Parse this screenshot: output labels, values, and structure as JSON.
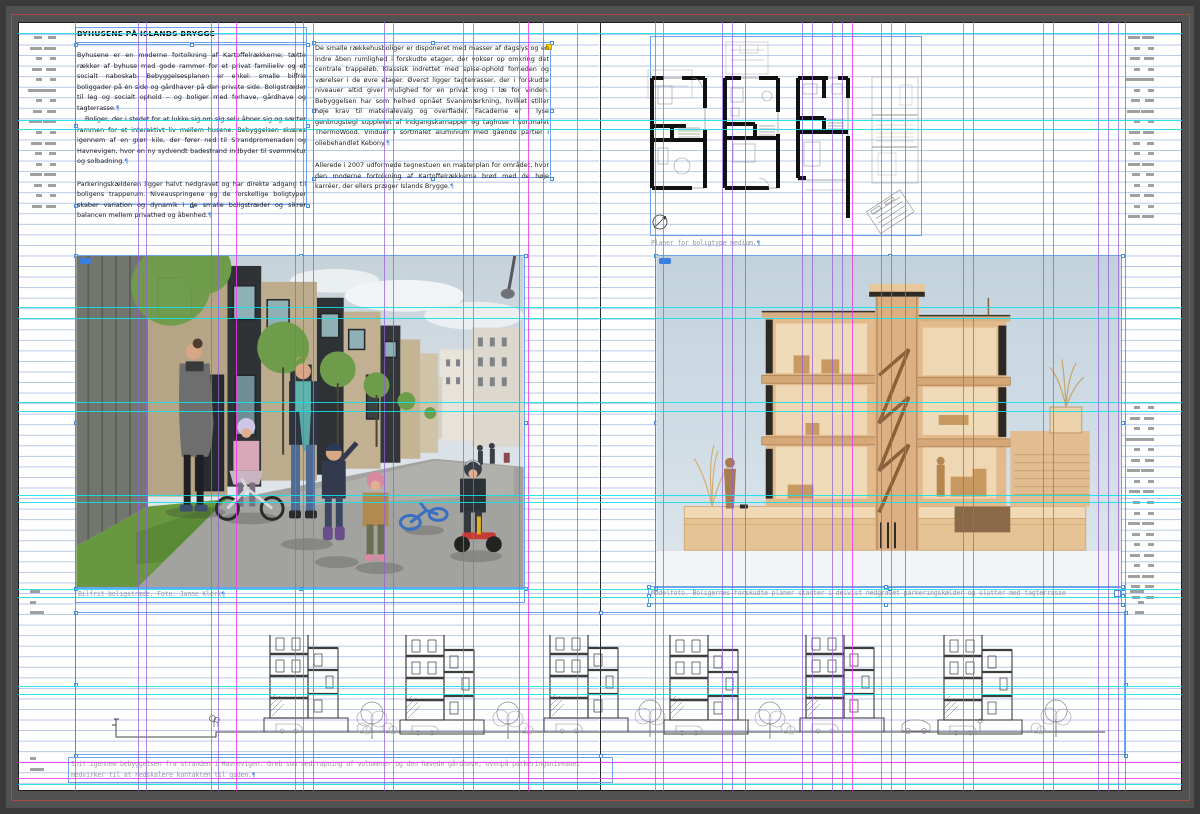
{
  "article": {
    "title": "BYHUSENE PÅ ISLANDS BRYGGE",
    "col1": [
      {
        "text": "Byhusene er en moderne fortolkning af Kartoffelrækkerne; tætte rækker af byhuse med gode rammer for et privat familieliv og et socialt naboskab. Bebyggelsesplanen er enkel: smalle bilfrie boliggader på én side og gårdhaver på den private side. Boligstræder til leg og socialt ophold – og boliger med forhave, gårdhave og tagterrasse.",
        "gap": false,
        "indent": false
      },
      {
        "text": "Boliger, der i stedet for at lukke sig om sig selv åbner sig og sætter rammen for et interaktivt liv mellem husene. Bebyggelsen skæres igennem af en grøn kile, der fører ned til Strandpromenaden og Havnevigen, hvor en ny sydvendt badestrand indbyder til svømmetur og solbadning.",
        "gap": false,
        "indent": true
      },
      {
        "text": "Parkeringskælderen ligger halvt nedgravet og har direkte adgang til boligens trapperum. Niveauspringene og de forskellige boligtyper skaber variation og dynamik i de smalle boligstræder og sikrer balancen mellem privathed og åbenhed.",
        "gap": true,
        "indent": false
      }
    ],
    "col2": [
      {
        "text": "De smalle rækkehusboliger er disponeret med masser af dagslys og en indre åben rumlighed i forskudte etager, der vokser op omkring det centrale trappeløb. Klassisk indrettet med spise-ophold forneden og værelser i de øvre etager. Øverst ligger tagterrasser, der i forskudte niveauer altid giver mulighed for en privat krog i læ for vinden. Bebyggelsen har som helhed opnået Svanemærkning, hvilket stiller høje krav til materialevalg og overflader. Facaderne er i lyse genbrugstegl suppleret af indgangskarnapper og taghuse i sortmalet ThermoWood. Vinduer i sortmalet aluminium med gående partier i oliebehandlet Kebony.",
        "gap": false,
        "indent": false
      },
      {
        "text": "Allerede i 2007 udformede tegnestuen en masterplan for området, hvor den moderne fortolkning af Kartoffelrækkerne brød med de høje karréer, der ellers præger Islands Brygge.",
        "gap": true,
        "indent": false
      }
    ]
  },
  "captions": {
    "plans": "Planer for boligtype medium.",
    "photo_left": "Bilfrit boligstræde. Foto: Janne Klerk",
    "photo_right": "Modelfoto. Boligernes forskudte planer starter i delvist nedgravet parkeringskælder og slutter med tagterrasse",
    "section": "Snit igennem bebyggelsen fra stranden i Havnevigen. Greb som nedtrapning af volumener og den hævede gårdhave, ovenpå parkeringsniveauet medvirker til at nedskalere kontakten til gaden."
  },
  "hidden_char": "¶",
  "colors": {
    "guide_violet": "rgba(150,95,216,0.75)",
    "guide_magenta": "rgba(236,60,236,0.85)",
    "guide_cyan": "rgba(20,224,232,0.9)",
    "frame_blue": "#6aa3ef",
    "bleed_red": "#a84a42",
    "baseline_blue": "#7d96d7"
  },
  "guides": {
    "vertical": [
      {
        "x": 75,
        "c": "v"
      },
      {
        "x": 138,
        "c": "v"
      },
      {
        "x": 146,
        "c": "v"
      },
      {
        "x": 211,
        "c": "v"
      },
      {
        "x": 218,
        "c": "v"
      },
      {
        "x": 236,
        "c": "m"
      },
      {
        "x": 295,
        "c": "v"
      },
      {
        "x": 303,
        "c": "v"
      },
      {
        "x": 313,
        "c": "m"
      },
      {
        "x": 384,
        "c": "v"
      },
      {
        "x": 393,
        "c": "v"
      },
      {
        "x": 463,
        "c": "v"
      },
      {
        "x": 473,
        "c": "v"
      },
      {
        "x": 519,
        "c": "v"
      },
      {
        "x": 528,
        "c": "m"
      },
      {
        "x": 543,
        "c": "v"
      },
      {
        "x": 577,
        "c": "v"
      },
      {
        "x": 655,
        "c": "v"
      },
      {
        "x": 663,
        "c": "v"
      },
      {
        "x": 722,
        "c": "v"
      },
      {
        "x": 732,
        "c": "v"
      },
      {
        "x": 745,
        "c": "m"
      },
      {
        "x": 802,
        "c": "v"
      },
      {
        "x": 812,
        "c": "v"
      },
      {
        "x": 832,
        "c": "v"
      },
      {
        "x": 842,
        "c": "v"
      },
      {
        "x": 852,
        "c": "m"
      },
      {
        "x": 881,
        "c": "v"
      },
      {
        "x": 891,
        "c": "v"
      },
      {
        "x": 905,
        "c": "m"
      },
      {
        "x": 963,
        "c": "v"
      },
      {
        "x": 973,
        "c": "v"
      },
      {
        "x": 1043,
        "c": "v"
      },
      {
        "x": 1053,
        "c": "v"
      },
      {
        "x": 1098,
        "c": "v"
      },
      {
        "x": 1108,
        "c": "v"
      },
      {
        "x": 1118,
        "c": "v"
      },
      {
        "x": 1125,
        "c": "m"
      }
    ],
    "horizontal": [
      {
        "y": 33,
        "c": "c"
      },
      {
        "y": 120,
        "c": "c"
      },
      {
        "y": 129,
        "c": "c"
      },
      {
        "y": 307,
        "c": "c"
      },
      {
        "y": 318,
        "c": "c"
      },
      {
        "y": 402,
        "c": "c"
      },
      {
        "y": 411,
        "c": "c"
      },
      {
        "y": 495,
        "c": "c"
      },
      {
        "y": 502,
        "c": "c"
      },
      {
        "y": 589,
        "c": "c"
      },
      {
        "y": 597,
        "c": "c"
      },
      {
        "y": 686,
        "c": "c"
      },
      {
        "y": 694,
        "c": "c"
      },
      {
        "y": 784,
        "c": "c"
      },
      {
        "y": 762,
        "c": "m"
      },
      {
        "y": 778,
        "c": "m"
      }
    ]
  },
  "slug": {
    "widths": [
      18,
      22,
      14,
      20,
      16,
      24,
      12,
      19,
      23,
      15,
      21,
      17,
      13,
      22,
      18,
      14,
      20,
      16,
      22,
      19
    ],
    "blocks": [
      {
        "x": 30,
        "y": 36,
        "rows": 17,
        "w": 26,
        "align": "right",
        "cols": 2
      },
      {
        "x": 1128,
        "y": 36,
        "rows": 18,
        "w": 26,
        "align": "right",
        "cols": 2
      },
      {
        "x": 1128,
        "y": 406,
        "rows": 19,
        "w": 26,
        "align": "right",
        "cols": 2
      },
      {
        "x": 30,
        "y": 590,
        "rows": 3,
        "w": 14,
        "align": "left",
        "cols": 1
      },
      {
        "x": 30,
        "y": 757,
        "rows": 2,
        "w": 12,
        "align": "left",
        "cols": 1
      },
      {
        "x": 1130,
        "y": 590,
        "rows": 3,
        "w": 14,
        "align": "right",
        "cols": 1
      }
    ]
  }
}
